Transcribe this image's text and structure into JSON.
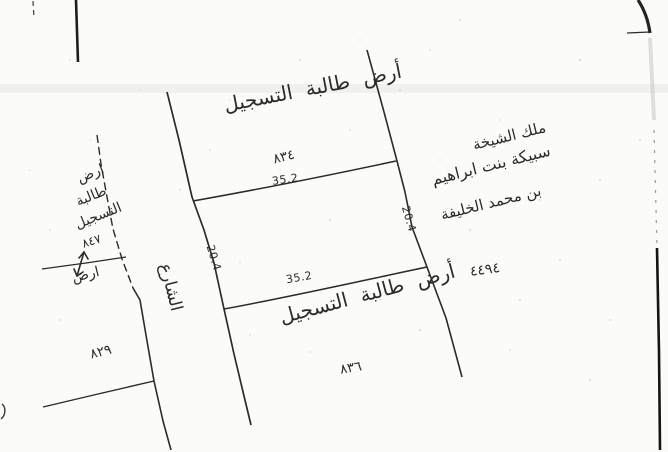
{
  "document": {
    "kind": "scanned hand-drawn cadastral survey sketch",
    "paper_color": "#fbfbf8",
    "ink_color": "#2d2b28"
  },
  "road": {
    "label": "الشارع"
  },
  "dimensions": {
    "top": "35.2",
    "bottom": "35.2",
    "left": "20.4",
    "right": "20.4"
  },
  "parcels": {
    "north": {
      "owner": "أرض طالبة التسجيل",
      "number": "٨٣٤"
    },
    "south": {
      "owner": "أرض طالبة التسجيل",
      "number": "٨٣٦"
    },
    "west_upper": {
      "owner_lines": [
        "ارض",
        "طالبة",
        "التسجيل"
      ],
      "number": "٨٤٧"
    },
    "west_mid": {
      "label": "ارض"
    },
    "west_lower": {
      "number": "٨٢٩"
    },
    "east": {
      "owner_lines": [
        "ملك الشيخة",
        "سبيكة بنت ابراهيم",
        "بن محمد الخليفة"
      ],
      "number": "٤٤٩٤"
    }
  }
}
